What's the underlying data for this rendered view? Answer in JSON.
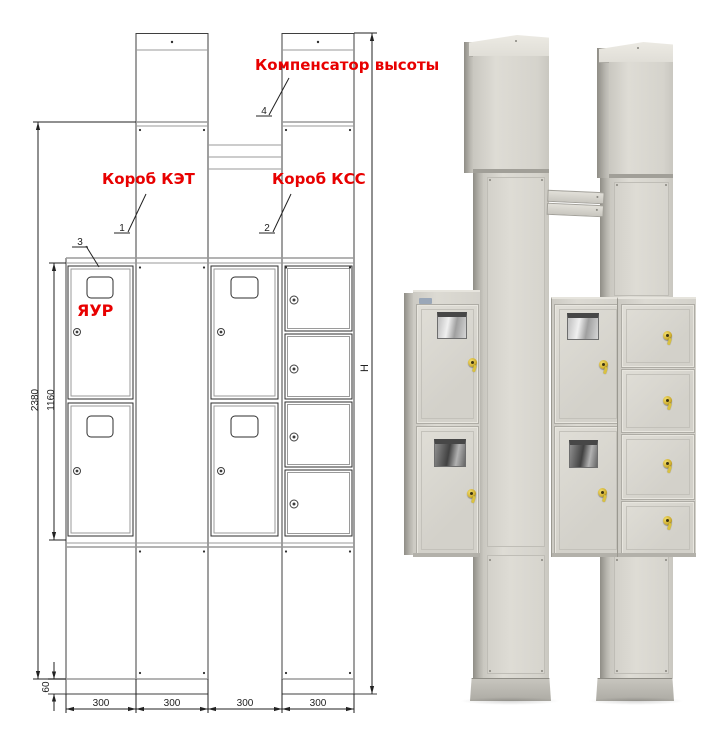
{
  "drawing": {
    "labels": {
      "compensator": "Компенсатор высоты",
      "korob_ket": "Короб КЭТ",
      "korob_kss": "Короб КСС",
      "yaur": "ЯУР"
    },
    "callouts": {
      "item1": "1",
      "item2": "2",
      "item3": "3",
      "item4": "4"
    },
    "dims": {
      "total_height": "2380",
      "door_section_height": "1160",
      "base_height": "60",
      "overall_height": "H",
      "modules": [
        "300",
        "300",
        "300",
        "300"
      ]
    },
    "colors": {
      "accent_red": "#e80000",
      "line_dark": "#333333",
      "line_gray": "#9a9a9a"
    }
  },
  "photo": {
    "colors": {
      "panel_face": "#d9d7d0",
      "panel_highlight": "#e4e2db",
      "panel_side": "#b3b1aa",
      "edge": "#97958d",
      "lock_yellow": "#d8bb3a",
      "window_frame": "#474747"
    }
  }
}
